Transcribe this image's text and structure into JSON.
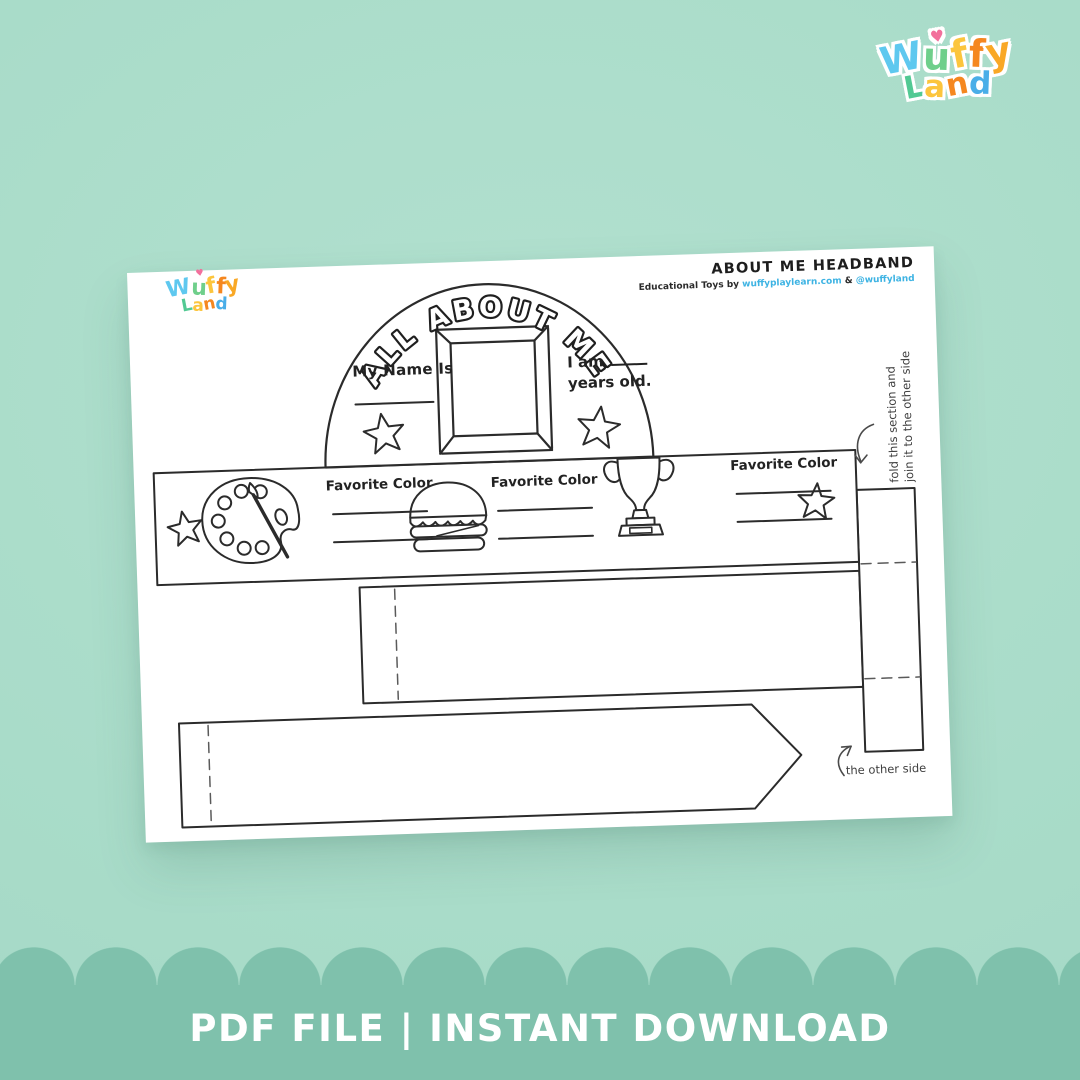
{
  "colors": {
    "background": "#a9dcc9",
    "banner": "#7fc1ac",
    "ink": "#2b2b2b",
    "link_blue": "#3db3e3",
    "heart_pink": "#f2709c"
  },
  "wordmark": {
    "line1": [
      {
        "ch": "W",
        "c": "#5ec8ef"
      },
      {
        "ch": "u",
        "c": "#6fcf8b",
        "heart": true,
        "heart_color": "#f2709c"
      },
      {
        "ch": "f",
        "c": "#fcc53d"
      },
      {
        "ch": "f",
        "c": "#f5871f"
      },
      {
        "ch": "y",
        "c": "#f9a826"
      }
    ],
    "line2": [
      {
        "ch": "L",
        "c": "#52c993"
      },
      {
        "ch": "a",
        "c": "#fcc53d"
      },
      {
        "ch": "n",
        "c": "#f5871f"
      },
      {
        "ch": "d",
        "c": "#4aaee8"
      }
    ]
  },
  "sheet": {
    "header": {
      "title": "ABOUT ME HEADBAND",
      "byline_prefix": "Educational Toys by",
      "site": "wuffyplaylearn.com",
      "amp": "&",
      "handle": "@wuffyland"
    },
    "crown": {
      "arch_text": "ALL ABOUT ME",
      "name_label": "My Name Is",
      "age_prefix": "I am",
      "age_suffix": "years old."
    },
    "band": {
      "groups": [
        {
          "label": "Favorite Color",
          "icon": "paint-palette-icon"
        },
        {
          "label": "Favorite Color",
          "icon": "burger-icon"
        },
        {
          "label": "Favorite Color",
          "icon": "trophy-icon"
        }
      ]
    },
    "annotations": {
      "fold_line1": "fold this section and",
      "fold_line2": "join it to the other side",
      "other_side": "the other side"
    }
  },
  "banner": {
    "label": "PDF FILE | INSTANT DOWNLOAD"
  }
}
